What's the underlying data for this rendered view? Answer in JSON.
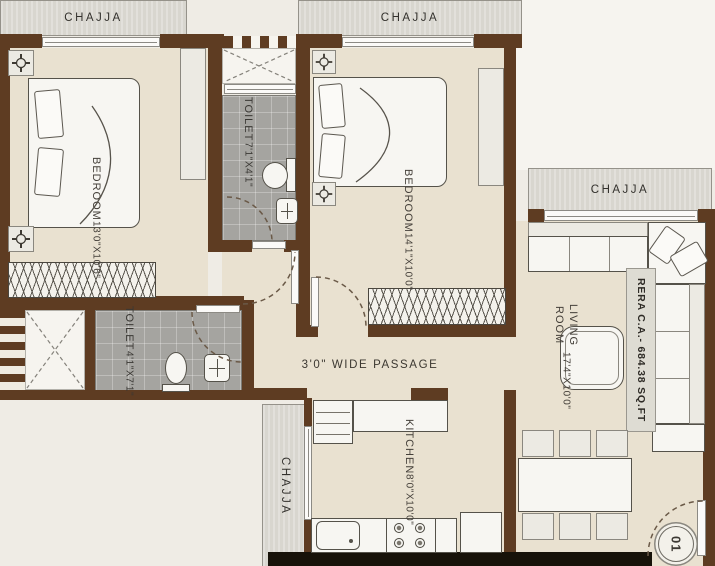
{
  "labels": {
    "chajja_top_left": "CHAJJA",
    "chajja_top_mid": "CHAJJA",
    "chajja_right": "CHAJJA",
    "chajja_kitchen": "CHAJJA",
    "passage": "3'0\" WIDE PASSAGE",
    "rera_area": "RERA C.A.- 684.38 SQ.FT",
    "unit_number": "01"
  },
  "rooms": {
    "bedroom1": {
      "name": "BEDROOM",
      "dims": "13'0\"X10'6\""
    },
    "bedroom2": {
      "name": "BEDROOM",
      "dims": "14'1\"X10'0\""
    },
    "toilet1": {
      "name": "TOILET",
      "dims": "7'1\"X4'1\""
    },
    "toilet2": {
      "name": "TOILET",
      "dims": "4'1\"X7'1\""
    },
    "living": {
      "name": "LIVING ROOM",
      "dims": "17'4\"X10'0\""
    },
    "kitchen": {
      "name": "KITCHEN",
      "dims": "8'0\"X10'0\""
    }
  },
  "colors": {
    "wall": "#5e3c22",
    "floor": "#e9e1d0",
    "toilet_floor": "#a5a4a0",
    "chajja_band": "#d8d6cf",
    "plinth_dark": "#171209"
  }
}
